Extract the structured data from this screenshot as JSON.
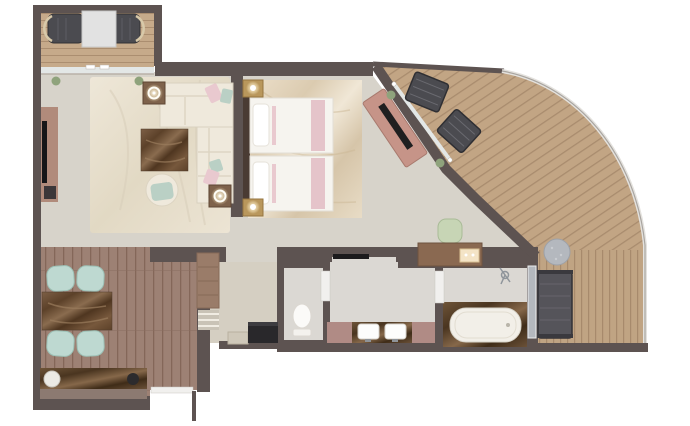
{
  "canvas": {
    "width": 690,
    "height": 426
  },
  "palette": {
    "wall": "#5d5351",
    "carpet": "#d7d3ca",
    "nook_floor": "#d5cfc2",
    "rug": "#ebe4d5",
    "deck": "#c4a887",
    "wood_floor": "#9f8376",
    "marble_light": "#e4d9c6",
    "sofa": "#efe9dc",
    "pillow_pink": "#e9c9cf",
    "pillow_mint": "#bad0c5",
    "chair_mint": "#bed9d1",
    "bed_white": "#f6f4ef",
    "accent_pink": "#e5c4ca",
    "brass": "#b9975c",
    "headboard": "#4a3b33",
    "dresser": "#c69488",
    "desk_wood": "#8a6951",
    "chair_green": "#c7d5b5",
    "lounge_dark": "#4b4b50",
    "table_gray": "#b4b8be",
    "daybed": "#55545a",
    "tub_white": "#f2efe8",
    "sink_white": "#fdfdfc",
    "mauve_cabinet": "#b08b85",
    "tv_panel": "#b18b7b",
    "glass": "#e3e7e6",
    "bath_floor": "#dbd8d3",
    "toilet_white": "#fbfaf8",
    "minibar_dark": "#29282b",
    "railing": "#e4e2de",
    "plant_green": "#8fa37c",
    "door_track": "#1c1b1d",
    "door_white": "#f1f0ee"
  },
  "floorplan": {
    "type": "suite-floor-plan",
    "rooms": [
      {
        "name": "forward-veranda",
        "furniture": [
          "deck-chair",
          "deck-chair",
          "deck-table",
          "sliding-glass-door"
        ]
      },
      {
        "name": "living-room",
        "furniture": [
          "l-shaped-sofa",
          "coffee-table",
          "armchair",
          "side-table-lamp",
          "side-table-lamp",
          "tv-panel",
          "area-rug",
          "floor-plant",
          "floor-plant"
        ]
      },
      {
        "name": "bedroom",
        "furniture": [
          "twin-bed",
          "twin-bed",
          "headboard",
          "nightstand-lamp",
          "nightstand-lamp",
          "writing-desk",
          "desk-chair",
          "tv-dresser"
        ]
      },
      {
        "name": "dining-area",
        "furniture": [
          "dining-table",
          "dining-chair",
          "dining-chair",
          "dining-chair",
          "dining-chair",
          "sideboard",
          "wardrobe",
          "shelf-unit",
          "minibar-cabinet"
        ]
      },
      {
        "name": "water-closet",
        "furniture": [
          "toilet"
        ]
      },
      {
        "name": "bathroom",
        "furniture": [
          "double-vanity",
          "sink",
          "sink"
        ]
      },
      {
        "name": "bathtub-room",
        "furniture": [
          "bathtub",
          "shower",
          "glass-panel"
        ]
      },
      {
        "name": "wraparound-balcony",
        "furniture": [
          "lounge-chair",
          "lounge-chair",
          "round-table",
          "daybed",
          "curved-railing",
          "planter",
          "planter"
        ]
      },
      {
        "name": "entry",
        "furniture": [
          "entry-door"
        ]
      }
    ]
  }
}
